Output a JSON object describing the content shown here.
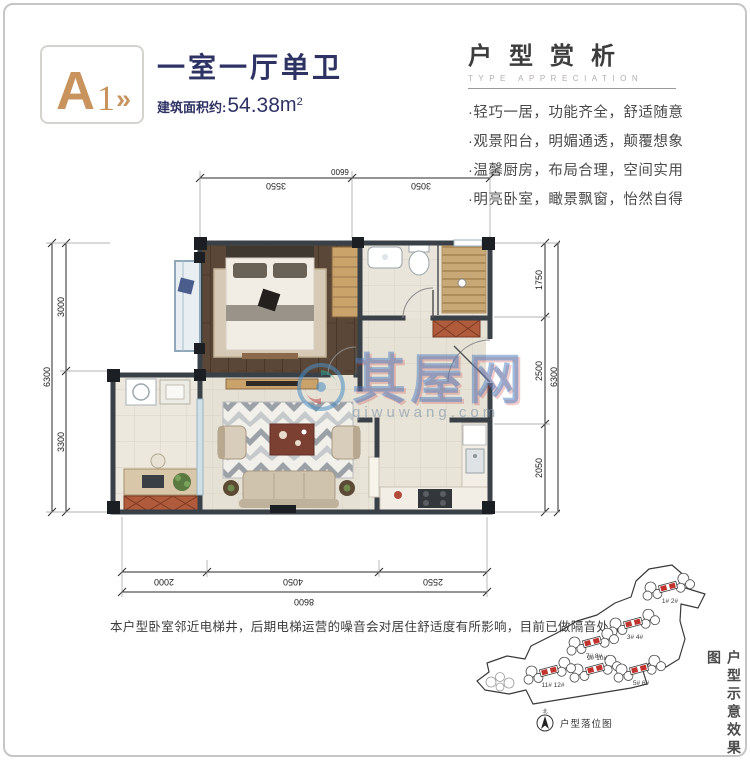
{
  "header": {
    "logo_letter": "A",
    "logo_number": "1",
    "logo_arrows": "»",
    "title": "一室一厅单卫",
    "area_label": "建筑面积约:",
    "area_value": "54.38",
    "area_unit": "m",
    "area_sup": "2"
  },
  "analysis": {
    "title": "户型赏析",
    "subtitle": "TYPE APPRECIATION",
    "features": [
      "·轻巧一居，功能齐全，舒适随意",
      "·观景阳台，明媚通透，颠覆想象",
      "·温馨厨房，布局合理，空间实用",
      "·明亮卧室，瞰景飘窗，怡然自得"
    ]
  },
  "floorplan": {
    "dims_top": {
      "total": "6600",
      "segments": [
        "3550",
        "3050"
      ]
    },
    "dims_left": {
      "total": "6300",
      "segments": [
        "3000",
        "3300"
      ]
    },
    "dims_right": {
      "total": "6300",
      "segments": [
        "1750",
        "2500",
        "2050"
      ]
    },
    "dims_bottom": {
      "total": "8600",
      "segments": [
        "2000",
        "4050",
        "2550"
      ]
    },
    "note": "本户型卧室邻近电梯井，后期电梯运营的噪音会对居住舒适度有所影响，目前已做隔音处理"
  },
  "watermark": {
    "name": "其屋网",
    "domain": "qiwuwang.com"
  },
  "siteplan": {
    "buildings": [
      {
        "label": "1# 2#"
      },
      {
        "label": "3# 4#"
      },
      {
        "label": "7# 8#"
      },
      {
        "label": "9# 10#"
      },
      {
        "label": "11# 12#"
      },
      {
        "label": "5# 6#"
      }
    ],
    "compass_label": "北",
    "caption": "户型落位图",
    "side_label": "户型示意效果图"
  },
  "colors": {
    "accent_gold": "#C9935D",
    "navy": "#2F3364",
    "wall": "#3A4047",
    "red_cabinet": "#B05C3C",
    "building_red": "#C2332E",
    "watermark_blue": "#4A7EC0"
  }
}
